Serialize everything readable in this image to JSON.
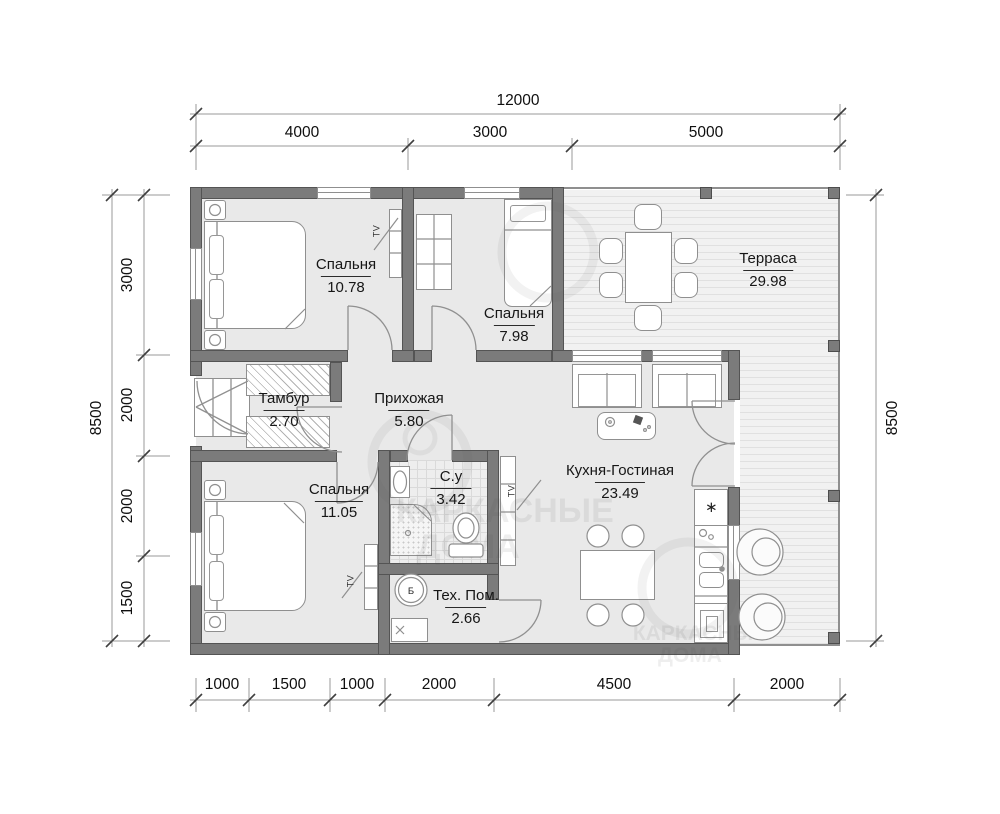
{
  "watermark": {
    "line1": "КАРКАСНЫЕ",
    "line2": "ДОМА"
  },
  "rooms": [
    {
      "name": "Спальня",
      "area": "10.78"
    },
    {
      "name": "Спальня",
      "area": "7.98"
    },
    {
      "name": "Терраса",
      "area": "29.98"
    },
    {
      "name": "Тамбур",
      "area": "2.70"
    },
    {
      "name": "Прихожая",
      "area": "5.80"
    },
    {
      "name": "Спальня",
      "area": "11.05"
    },
    {
      "name": "С.у",
      "area": "3.42"
    },
    {
      "name": "Кухня-Гостиная",
      "area": "23.49"
    },
    {
      "name": "Тех. Пом.",
      "area": "2.66"
    }
  ],
  "dims": {
    "top_total": "12000",
    "top": [
      "4000",
      "3000",
      "5000"
    ],
    "left_total": "8500",
    "left": [
      "3000",
      "2000",
      "2000",
      "1500"
    ],
    "right_total": "8500",
    "bottom": [
      "1000",
      "1500",
      "1000",
      "2000",
      "4500",
      "2000"
    ]
  },
  "icons": {
    "tv": "TV",
    "boiler": "Б",
    "fridge": "∗"
  },
  "colors": {
    "wall": "#7b7b7b",
    "floor": "#e9e9e9",
    "deck": "#f1f1f1",
    "text": "#161616"
  }
}
